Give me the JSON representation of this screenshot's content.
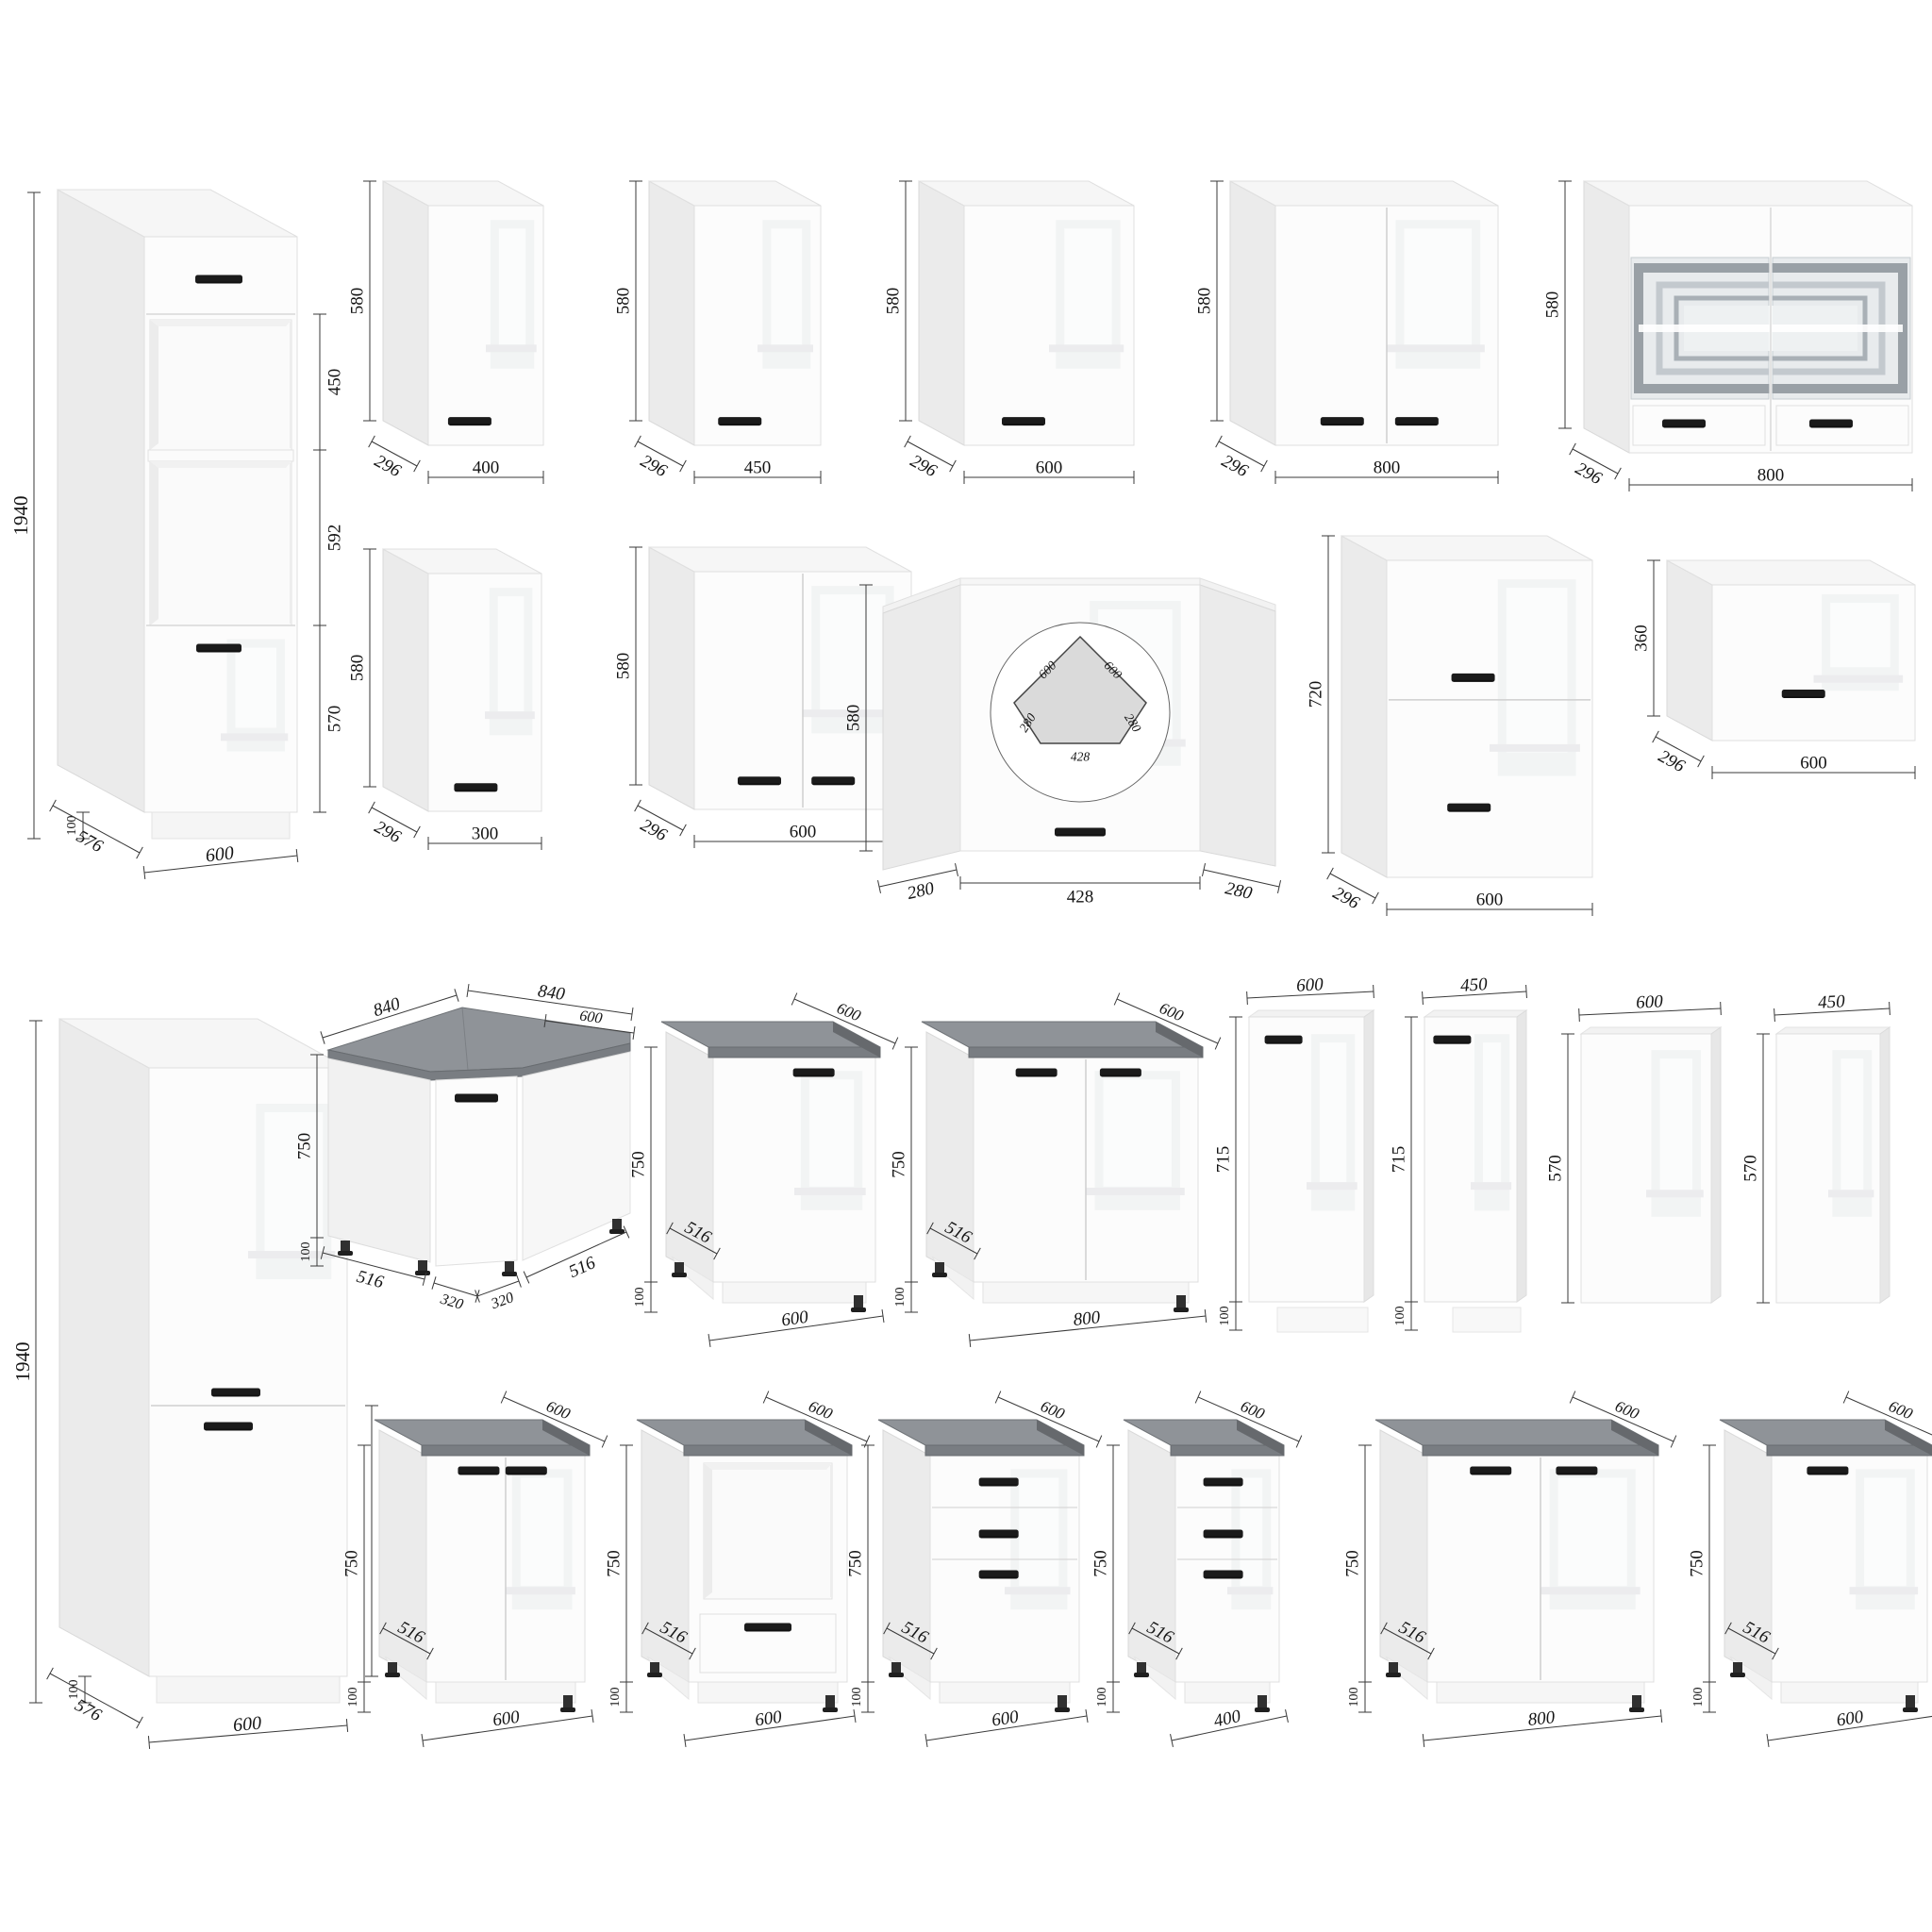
{
  "colors": {
    "background": "#ffffff",
    "front": "#fcfcfc",
    "front_stroke": "#dfdfdf",
    "side": "#ebebeb",
    "side_stroke": "#d9d9d9",
    "top": "#f6f6f6",
    "worktop_top": "#8f9398",
    "worktop_edge": "#797d82",
    "handle": "#1b1b1b",
    "glass": "#e8ebed",
    "glass_frame_dark": "#99a0a6",
    "glass_frame_light": "#c3c9ce",
    "dim_line": "#3a3a3a",
    "dim_text": "#141414"
  },
  "cabinets": [
    {
      "id": "tall-oven-600",
      "kind": "tall-oven",
      "doors": 1,
      "drawers": 1,
      "dims": {
        "height": "1940",
        "plinth": "100",
        "depth": "576",
        "width": "600",
        "sections": [
          "450",
          "592",
          "570"
        ]
      }
    },
    {
      "id": "wall-400",
      "kind": "wall",
      "doors": 1,
      "dims": {
        "height": "580",
        "width": "400",
        "depth": "296"
      }
    },
    {
      "id": "wall-450",
      "kind": "wall",
      "doors": 1,
      "dims": {
        "height": "580",
        "width": "450",
        "depth": "296"
      }
    },
    {
      "id": "wall-600",
      "kind": "wall",
      "doors": 1,
      "dims": {
        "height": "580",
        "width": "600",
        "depth": "296"
      }
    },
    {
      "id": "wall-800",
      "kind": "wall",
      "doors": 2,
      "dims": {
        "height": "580",
        "width": "800",
        "depth": "296"
      }
    },
    {
      "id": "wall-800-glass",
      "kind": "wall-glass",
      "doors": 2,
      "dims": {
        "height": "580",
        "width": "800",
        "depth": "296"
      }
    },
    {
      "id": "wall-300",
      "kind": "wall",
      "doors": 1,
      "dims": {
        "height": "580",
        "width": "300",
        "depth": "296"
      }
    },
    {
      "id": "wall-600-double",
      "kind": "wall",
      "doors": 2,
      "dims": {
        "height": "580",
        "width": "600",
        "depth": "296"
      }
    },
    {
      "id": "wall-corner",
      "kind": "corner-wall",
      "doors": 1,
      "dims": {
        "height": "580",
        "front": "428",
        "side_left": "280",
        "side_right": "280"
      },
      "plan": {
        "back_left": "600",
        "back_right": "600",
        "side_left": "280",
        "side_right": "280",
        "front": "428"
      }
    },
    {
      "id": "wall-600-720",
      "kind": "wall-flip",
      "doors": 2,
      "dims": {
        "height": "720",
        "width": "600",
        "depth": "296"
      }
    },
    {
      "id": "wall-600-360",
      "kind": "wall-flip",
      "doors": 1,
      "dims": {
        "height": "360",
        "width": "600",
        "depth": "296"
      }
    },
    {
      "id": "tall-fridge-600",
      "kind": "tall-fridge",
      "doors": 2,
      "dims": {
        "height": "1940",
        "plinth": "100",
        "depth": "576",
        "width": "600",
        "lower_door": "720"
      }
    },
    {
      "id": "base-corner",
      "kind": "corner-base",
      "doors": 1,
      "dims": {
        "top_left": "840",
        "top_right": "840",
        "worktop_depth": "600",
        "height": "750",
        "plinth": "100",
        "bottom_left": "516",
        "front_left": "320",
        "front_right": "320",
        "bottom_right": "516"
      }
    },
    {
      "id": "base-600",
      "kind": "base",
      "doors": 1,
      "dims": {
        "worktop_depth": "600",
        "height": "750",
        "plinth": "100",
        "depth": "516",
        "width": "600"
      }
    },
    {
      "id": "base-800",
      "kind": "base",
      "doors": 2,
      "dims": {
        "worktop_depth": "600",
        "height": "750",
        "plinth": "100",
        "depth": "516",
        "width": "800"
      }
    },
    {
      "id": "front-600-715",
      "kind": "front-panel",
      "dims": {
        "width": "600",
        "height": "715",
        "gap": "100"
      }
    },
    {
      "id": "front-450-715",
      "kind": "front-panel",
      "dims": {
        "width": "450",
        "height": "715",
        "gap": "100"
      }
    },
    {
      "id": "panel-600-570",
      "kind": "side-panel",
      "dims": {
        "width": "600",
        "height": "570"
      }
    },
    {
      "id": "panel-450-570",
      "kind": "side-panel",
      "dims": {
        "width": "450",
        "height": "570"
      }
    },
    {
      "id": "base-600-double",
      "kind": "base",
      "doors": 2,
      "dims": {
        "worktop_depth": "600",
        "height": "750",
        "plinth": "100",
        "depth": "516",
        "width": "600"
      }
    },
    {
      "id": "base-600-oven",
      "kind": "base-oven",
      "doors": 0,
      "dims": {
        "worktop_depth": "600",
        "height": "750",
        "plinth": "100",
        "depth": "516",
        "width": "600"
      }
    },
    {
      "id": "base-600-drawers",
      "kind": "base-drawers",
      "drawers": 3,
      "dims": {
        "worktop_depth": "600",
        "height": "750",
        "plinth": "100",
        "depth": "516",
        "width": "600"
      }
    },
    {
      "id": "base-400-drawers",
      "kind": "base-drawers",
      "drawers": 3,
      "dims": {
        "worktop_depth": "600",
        "height": "750",
        "plinth": "100",
        "depth": "516",
        "width": "400"
      }
    },
    {
      "id": "base-800-double",
      "kind": "base",
      "doors": 2,
      "dims": {
        "worktop_depth": "600",
        "height": "750",
        "plinth": "100",
        "depth": "516",
        "width": "800"
      }
    },
    {
      "id": "base-600-single",
      "kind": "base",
      "doors": 1,
      "dims": {
        "worktop_depth": "600",
        "height": "750",
        "plinth": "100",
        "depth": "516",
        "width": "600"
      }
    }
  ]
}
